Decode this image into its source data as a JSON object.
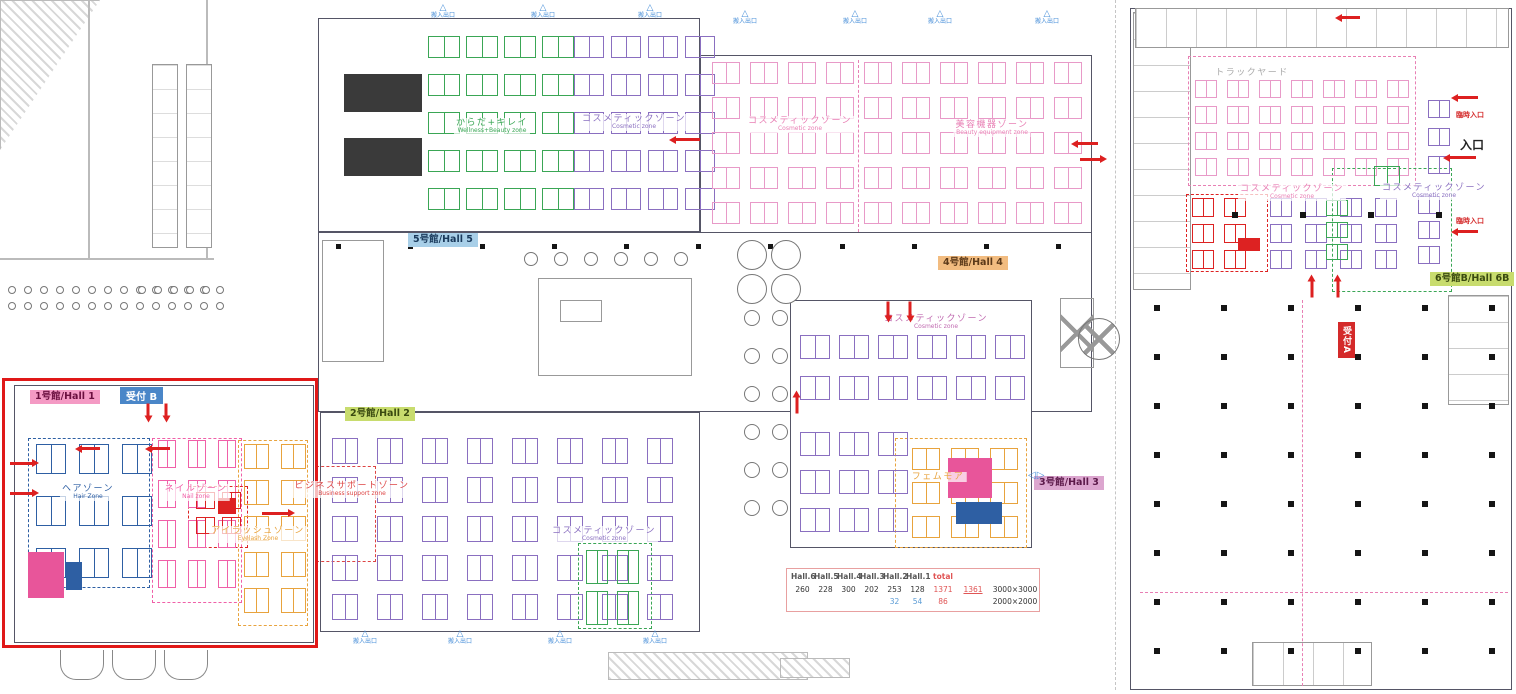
{
  "floorplan": {
    "buildings": [
      {
        "x": 318,
        "y": 18,
        "w": 382,
        "h": 214,
        "name": "hall5-building"
      },
      {
        "x": 700,
        "y": 55,
        "w": 392,
        "h": 180,
        "name": "hall4-building"
      },
      {
        "x": 318,
        "y": 232,
        "w": 774,
        "h": 180,
        "name": "concourse"
      },
      {
        "x": 14,
        "y": 385,
        "w": 300,
        "h": 258,
        "name": "hall1-building"
      },
      {
        "x": 320,
        "y": 412,
        "w": 380,
        "h": 220,
        "name": "hall2-building"
      },
      {
        "x": 790,
        "y": 300,
        "w": 242,
        "h": 248,
        "name": "hall3-building"
      },
      {
        "x": 1130,
        "y": 8,
        "w": 382,
        "h": 682,
        "name": "hall6-building"
      }
    ],
    "inner_rects": [
      {
        "x": 538,
        "y": 278,
        "w": 154,
        "h": 98,
        "pat": "none"
      },
      {
        "x": 560,
        "y": 300,
        "w": 42,
        "h": 22,
        "pat": "none"
      },
      {
        "x": 322,
        "y": 240,
        "w": 62,
        "h": 122,
        "pat": "none"
      },
      {
        "x": 1133,
        "y": 12,
        "w": 58,
        "h": 278,
        "pat": "h"
      },
      {
        "x": 1135,
        "y": 8,
        "w": 374,
        "h": 40,
        "pat": "v"
      },
      {
        "x": 1448,
        "y": 295,
        "w": 61,
        "h": 110,
        "pat": "h"
      },
      {
        "x": 1252,
        "y": 642,
        "w": 120,
        "h": 44,
        "pat": "v"
      },
      {
        "x": 1060,
        "y": 298,
        "w": 34,
        "h": 70,
        "pat": "x"
      }
    ],
    "red_highlight": {
      "x": 2,
      "y": 378,
      "w": 316,
      "h": 270
    },
    "booth_grids": [
      {
        "x": 428,
        "y": 36,
        "cols": 4,
        "rows": 5,
        "cw": 32,
        "ch": 22,
        "gx": 6,
        "gy": 16,
        "color": "#3aa655"
      },
      {
        "x": 574,
        "y": 36,
        "cols": 4,
        "rows": 5,
        "cw": 30,
        "ch": 22,
        "gx": 7,
        "gy": 16,
        "color": "#8a6fc0"
      },
      {
        "x": 712,
        "y": 62,
        "cols": 10,
        "rows": 5,
        "cw": 28,
        "ch": 22,
        "gx": 10,
        "gy": 13,
        "color": "#e89ac8"
      },
      {
        "x": 800,
        "y": 335,
        "cols": 6,
        "rows": 2,
        "cw": 30,
        "ch": 24,
        "gx": 9,
        "gy": 17,
        "color": "#8a6fc0"
      },
      {
        "x": 800,
        "y": 432,
        "cols": 3,
        "rows": 3,
        "cw": 30,
        "ch": 24,
        "gx": 9,
        "gy": 14,
        "color": "#8a6fc0"
      },
      {
        "x": 912,
        "y": 448,
        "cols": 3,
        "rows": 3,
        "cw": 28,
        "ch": 22,
        "gx": 11,
        "gy": 12,
        "color": "#e8a33d"
      },
      {
        "x": 36,
        "y": 444,
        "cols": 3,
        "rows": 3,
        "cw": 30,
        "ch": 30,
        "gx": 13,
        "gy": 22,
        "color": "#2e5fa3"
      },
      {
        "x": 158,
        "y": 440,
        "cols": 3,
        "rows": 4,
        "cw": 18,
        "ch": 28,
        "gx": 12,
        "gy": 12,
        "color": "#f060a8"
      },
      {
        "x": 244,
        "y": 444,
        "cols": 2,
        "rows": 5,
        "cw": 25,
        "ch": 25,
        "gx": 12,
        "gy": 11,
        "color": "#e8a33d"
      },
      {
        "x": 196,
        "y": 492,
        "cols": 2,
        "rows": 2,
        "cw": 19,
        "ch": 17,
        "gx": 7,
        "gy": 8,
        "color": "#dd2222"
      },
      {
        "x": 332,
        "y": 438,
        "cols": 8,
        "rows": 5,
        "cw": 26,
        "ch": 26,
        "gx": 19,
        "gy": 13,
        "color": "#8a6fc0"
      },
      {
        "x": 586,
        "y": 550,
        "cols": 2,
        "rows": 2,
        "cw": 22,
        "ch": 34,
        "gx": 9,
        "gy": 7,
        "color": "#3aa655"
      },
      {
        "x": 1195,
        "y": 80,
        "cols": 7,
        "rows": 4,
        "cw": 22,
        "ch": 18,
        "gx": 10,
        "gy": 8,
        "color": "#e89ac8"
      },
      {
        "x": 1192,
        "y": 198,
        "cols": 2,
        "rows": 3,
        "cw": 22,
        "ch": 19,
        "gx": 10,
        "gy": 7,
        "color": "#dd2222"
      },
      {
        "x": 1270,
        "y": 198,
        "cols": 4,
        "rows": 3,
        "cw": 22,
        "ch": 19,
        "gx": 13,
        "gy": 7,
        "color": "#8a6fc0"
      },
      {
        "x": 1428,
        "y": 100,
        "cols": 1,
        "rows": 3,
        "cw": 22,
        "ch": 18,
        "gx": 0,
        "gy": 10,
        "color": "#8a6fc0"
      },
      {
        "x": 1374,
        "y": 166,
        "cols": 1,
        "rows": 1,
        "cw": 26,
        "ch": 20,
        "gx": 0,
        "gy": 0,
        "color": "#3aa655"
      },
      {
        "x": 1326,
        "y": 200,
        "cols": 1,
        "rows": 3,
        "cw": 22,
        "ch": 16,
        "gx": 0,
        "gy": 6,
        "color": "#3aa655"
      },
      {
        "x": 1418,
        "y": 196,
        "cols": 1,
        "rows": 3,
        "cw": 22,
        "ch": 18,
        "gx": 0,
        "gy": 7,
        "color": "#8a6fc0"
      }
    ],
    "dashed_zones": [
      {
        "x": 28,
        "y": 438,
        "w": 122,
        "h": 150,
        "color": "#2e5fa3"
      },
      {
        "x": 152,
        "y": 438,
        "w": 90,
        "h": 165,
        "color": "#f060a8"
      },
      {
        "x": 238,
        "y": 440,
        "w": 70,
        "h": 186,
        "color": "#e8a33d"
      },
      {
        "x": 188,
        "y": 486,
        "w": 60,
        "h": 62,
        "color": "#dd2222"
      },
      {
        "x": 316,
        "y": 466,
        "w": 60,
        "h": 96,
        "color": "#dd4444"
      },
      {
        "x": 578,
        "y": 543,
        "w": 74,
        "h": 86,
        "color": "#3aa655"
      },
      {
        "x": 895,
        "y": 438,
        "w": 132,
        "h": 110,
        "color": "#e8a33d"
      },
      {
        "x": 1188,
        "y": 56,
        "w": 228,
        "h": 130,
        "color": "#e87fb4"
      },
      {
        "x": 1186,
        "y": 194,
        "w": 82,
        "h": 78,
        "color": "#dd2222"
      },
      {
        "x": 1332,
        "y": 168,
        "w": 120,
        "h": 124,
        "color": "#3aa655"
      }
    ],
    "dashed_lines": [
      {
        "x": 1302,
        "y": 300,
        "len": 386,
        "dir": "v",
        "color": "#e87fb4"
      },
      {
        "x": 1140,
        "y": 592,
        "len": 368,
        "dir": "h",
        "color": "#e87fb4"
      },
      {
        "x": 1115,
        "y": 0,
        "len": 690,
        "dir": "v",
        "color": "#c5c5c5"
      },
      {
        "x": 858,
        "y": 60,
        "len": 172,
        "dir": "v",
        "color": "#e87fb4"
      }
    ],
    "solid_blocks": [
      {
        "x": 344,
        "y": 74,
        "w": 78,
        "h": 38,
        "color": "#3a3a3a",
        "name": "seating-block"
      },
      {
        "x": 344,
        "y": 138,
        "w": 78,
        "h": 38,
        "color": "#3a3a3a",
        "name": "seating-block"
      },
      {
        "x": 218,
        "y": 498,
        "w": 18,
        "h": 16,
        "color": "#dd2222",
        "name": "featured-booth"
      },
      {
        "x": 1238,
        "y": 238,
        "w": 22,
        "h": 13,
        "color": "#dd2222",
        "name": "featured-booth"
      },
      {
        "x": 28,
        "y": 552,
        "w": 36,
        "h": 46,
        "color": "#e8559a",
        "name": "stage-block"
      },
      {
        "x": 66,
        "y": 562,
        "w": 16,
        "h": 28,
        "color": "#2e5fa3",
        "name": "stage-block"
      },
      {
        "x": 948,
        "y": 458,
        "w": 44,
        "h": 40,
        "color": "#e8559a",
        "name": "stage-block"
      },
      {
        "x": 956,
        "y": 502,
        "w": 46,
        "h": 22,
        "color": "#2e5fa3",
        "name": "stage-block"
      }
    ],
    "column_grids": [
      {
        "x0": 1154,
        "y0": 305,
        "cols": 6,
        "rows": 8,
        "dx": 67,
        "dy": 49,
        "s": 6
      },
      {
        "x0": 336,
        "y0": 244,
        "cols": 11,
        "rows": 1,
        "dx": 72,
        "dy": 0,
        "s": 5
      },
      {
        "x0": 1232,
        "y0": 212,
        "cols": 4,
        "rows": 1,
        "dx": 68,
        "dy": 0,
        "s": 6
      }
    ],
    "circle_rows": [
      {
        "x0": 524,
        "y0": 252,
        "n": 6,
        "dx": 30,
        "dy": 0,
        "r": 7
      },
      {
        "x0": 737,
        "y0": 240,
        "n": 2,
        "dx": 34,
        "dy": 0,
        "r": 15
      },
      {
        "x0": 737,
        "y0": 274,
        "n": 2,
        "dx": 34,
        "dy": 0,
        "r": 15
      },
      {
        "x0": 744,
        "y0": 310,
        "n": 6,
        "dx": 0,
        "dy": 38,
        "r": 8
      },
      {
        "x0": 772,
        "y0": 310,
        "n": 6,
        "dx": 0,
        "dy": 38,
        "r": 8
      },
      {
        "x0": 8,
        "y0": 286,
        "n": 14,
        "dx": 16,
        "dy": 0,
        "r": 4
      },
      {
        "x0": 8,
        "y0": 302,
        "n": 14,
        "dx": 16,
        "dy": 0,
        "r": 4
      },
      {
        "x0": 138,
        "y0": 286,
        "n": 5,
        "dx": 16,
        "dy": 0,
        "r": 4
      }
    ],
    "cross_circle": {
      "x": 1078,
      "y": 318,
      "r": 21
    },
    "zone_labels": [
      {
        "jp": "からだ+キレイ",
        "en": "Wellness+Beauty zone",
        "color": "#3aa655",
        "x": 492,
        "y": 118
      },
      {
        "jp": "コスメティックゾーン",
        "en": "Cosmetic zone",
        "color": "#8a6fc0",
        "x": 634,
        "y": 114
      },
      {
        "jp": "コスメティックゾーン",
        "en": "Cosmetic zone",
        "color": "#e87fb4",
        "x": 800,
        "y": 116
      },
      {
        "jp": "美容機器ゾーン",
        "en": "Beauty equipment zone",
        "color": "#e87fb4",
        "x": 992,
        "y": 120
      },
      {
        "jp": "コスメティックゾーン",
        "en": "Cosmetic zone",
        "color": "#c06ab0",
        "x": 936,
        "y": 314
      },
      {
        "jp": "フェムモア",
        "en": "",
        "color": "#e8a33d",
        "x": 938,
        "y": 472
      },
      {
        "jp": "ヘアゾーン",
        "en": "Hair Zone",
        "color": "#2e5fa3",
        "x": 88,
        "y": 484
      },
      {
        "jp": "ネイルゾーン",
        "en": "Nail zone",
        "color": "#f060a8",
        "x": 196,
        "y": 484
      },
      {
        "jp": "アイラッシュゾーン",
        "en": "Eyelash Zone",
        "color": "#e8a33d",
        "x": 258,
        "y": 526
      },
      {
        "jp": "ビジネスサポートゾーン",
        "en": "Business support zone",
        "color": "#dd4444",
        "x": 352,
        "y": 481
      },
      {
        "jp": "コスメティックゾーン",
        "en": "Cosmetic zone",
        "color": "#8a6fc0",
        "x": 604,
        "y": 526
      },
      {
        "jp": "コスメティックゾーン",
        "en": "Cosmetic zone",
        "color": "#e87fb4",
        "x": 1292,
        "y": 184
      },
      {
        "jp": "コスメティックゾーン",
        "en": "Cosmetic zone",
        "color": "#8a6fc0",
        "x": 1434,
        "y": 183
      },
      {
        "jp": "トラックヤード",
        "en": "",
        "color": "#aaaaaa",
        "x": 1252,
        "y": 68
      }
    ],
    "hall_badges": [
      {
        "label": "5号館/Hall 5",
        "x": 408,
        "y": 233,
        "bg": "#a8cfe8",
        "color": "#1a3a5c"
      },
      {
        "label": "4号館/Hall 4",
        "x": 938,
        "y": 256,
        "bg": "#f2bc80",
        "color": "#5c3a1a"
      },
      {
        "label": "1号館/Hall 1",
        "x": 30,
        "y": 390,
        "bg": "#f49ac4",
        "color": "#6b1040"
      },
      {
        "label": "2号館/Hall 2",
        "x": 345,
        "y": 407,
        "bg": "#c8dc6e",
        "color": "#3a4a10"
      },
      {
        "label": "3号館/Hall 3",
        "x": 1034,
        "y": 476,
        "bg": "#dca6cf",
        "color": "#5c1a4a"
      },
      {
        "label": "6号館B/Hall 6B",
        "x": 1430,
        "y": 272,
        "bg": "#c8dc6e",
        "color": "#3a4a10"
      }
    ],
    "receptions": [
      {
        "label": "受付 B",
        "x": 120,
        "y": 387,
        "bg": "#4a86c8",
        "color": "#ffffff",
        "vertical": false
      },
      {
        "label": "受付A",
        "x": 1338,
        "y": 322,
        "bg": "#d42a2a",
        "color": "#ffffff",
        "vertical": true
      }
    ],
    "entrances": [
      {
        "label": "臨時入口",
        "x": 1470,
        "y": 110,
        "color": "#d42a2a",
        "size": 7
      },
      {
        "label": "入口",
        "x": 1472,
        "y": 136,
        "color": "#222222",
        "size": 12
      },
      {
        "label": "臨時入口",
        "x": 1470,
        "y": 216,
        "color": "#d42a2a",
        "size": 7
      }
    ],
    "gates": [
      {
        "x": 443,
        "y": 4
      },
      {
        "x": 543,
        "y": 4
      },
      {
        "x": 650,
        "y": 4
      },
      {
        "x": 745,
        "y": 10
      },
      {
        "x": 855,
        "y": 10
      },
      {
        "x": 940,
        "y": 10
      },
      {
        "x": 1047,
        "y": 10
      },
      {
        "x": 365,
        "y": 630
      },
      {
        "x": 460,
        "y": 630
      },
      {
        "x": 560,
        "y": 630
      },
      {
        "x": 655,
        "y": 630
      }
    ],
    "gate_label": "搬入出口",
    "blue_markers": [
      {
        "x": 1028,
        "y": 470,
        "text": "◁▷"
      }
    ],
    "arrows": [
      {
        "x": 10,
        "y": 462,
        "dir": "right",
        "len": 22
      },
      {
        "x": 10,
        "y": 492,
        "dir": "right",
        "len": 22
      },
      {
        "x": 262,
        "y": 512,
        "dir": "right",
        "len": 26
      },
      {
        "x": 100,
        "y": 447,
        "dir": "left",
        "len": 18
      },
      {
        "x": 170,
        "y": 447,
        "dir": "left",
        "len": 18
      },
      {
        "x": 148,
        "y": 402,
        "dir": "down",
        "len": 12
      },
      {
        "x": 166,
        "y": 402,
        "dir": "down",
        "len": 12
      },
      {
        "x": 700,
        "y": 138,
        "dir": "left",
        "len": 24
      },
      {
        "x": 1098,
        "y": 142,
        "dir": "left",
        "len": 20
      },
      {
        "x": 1080,
        "y": 158,
        "dir": "right",
        "len": 20
      },
      {
        "x": 888,
        "y": 300,
        "dir": "down",
        "len": 14
      },
      {
        "x": 910,
        "y": 300,
        "dir": "down",
        "len": 14
      },
      {
        "x": 797,
        "y": 412,
        "dir": "up",
        "len": 16
      },
      {
        "x": 1478,
        "y": 96,
        "dir": "left",
        "len": 20
      },
      {
        "x": 1476,
        "y": 156,
        "dir": "left",
        "len": 26
      },
      {
        "x": 1478,
        "y": 230,
        "dir": "left",
        "len": 20
      },
      {
        "x": 1312,
        "y": 296,
        "dir": "up",
        "len": 16
      },
      {
        "x": 1338,
        "y": 296,
        "dir": "up",
        "len": 16
      },
      {
        "x": 1360,
        "y": 16,
        "dir": "left",
        "len": 18
      }
    ],
    "table": {
      "x": 786,
      "y": 568,
      "w": 244,
      "headers": [
        {
          "t": "Hall.6",
          "c": "#555555"
        },
        {
          "t": "Hall.5",
          "c": "#555555"
        },
        {
          "t": "Hall.4",
          "c": "#555555"
        },
        {
          "t": "Hall.3",
          "c": "#555555"
        },
        {
          "t": "Hall.2",
          "c": "#555555"
        },
        {
          "t": "Hall.1",
          "c": "#555555"
        },
        {
          "t": "total",
          "c": "#e05555"
        }
      ],
      "rows": [
        {
          "cells": [
            {
              "t": "260",
              "c": "#333333"
            },
            {
              "t": "228",
              "c": "#333333"
            },
            {
              "t": "300",
              "c": "#333333"
            },
            {
              "t": "202",
              "c": "#333333"
            },
            {
              "t": "253",
              "c": "#333333"
            },
            {
              "t": "128",
              "c": "#333333"
            },
            {
              "t": "1371",
              "c": "#e05555"
            }
          ],
          "extra": {
            "t": "1361",
            "c": "#e05555",
            "u": true
          },
          "size": {
            "t": "3000×3000",
            "c": "#333333"
          }
        },
        {
          "cells": [
            {
              "t": "",
              "c": "#333333"
            },
            {
              "t": "",
              "c": "#333333"
            },
            {
              "t": "",
              "c": "#333333"
            },
            {
              "t": "",
              "c": "#333333"
            },
            {
              "t": "32",
              "c": "#5b9bd5"
            },
            {
              "t": "54",
              "c": "#5b9bd5"
            },
            {
              "t": "86",
              "c": "#e05555"
            }
          ],
          "extra": {
            "t": "",
            "c": "#333333"
          },
          "size": {
            "t": "2000×2000",
            "c": "#333333"
          }
        }
      ]
    }
  }
}
